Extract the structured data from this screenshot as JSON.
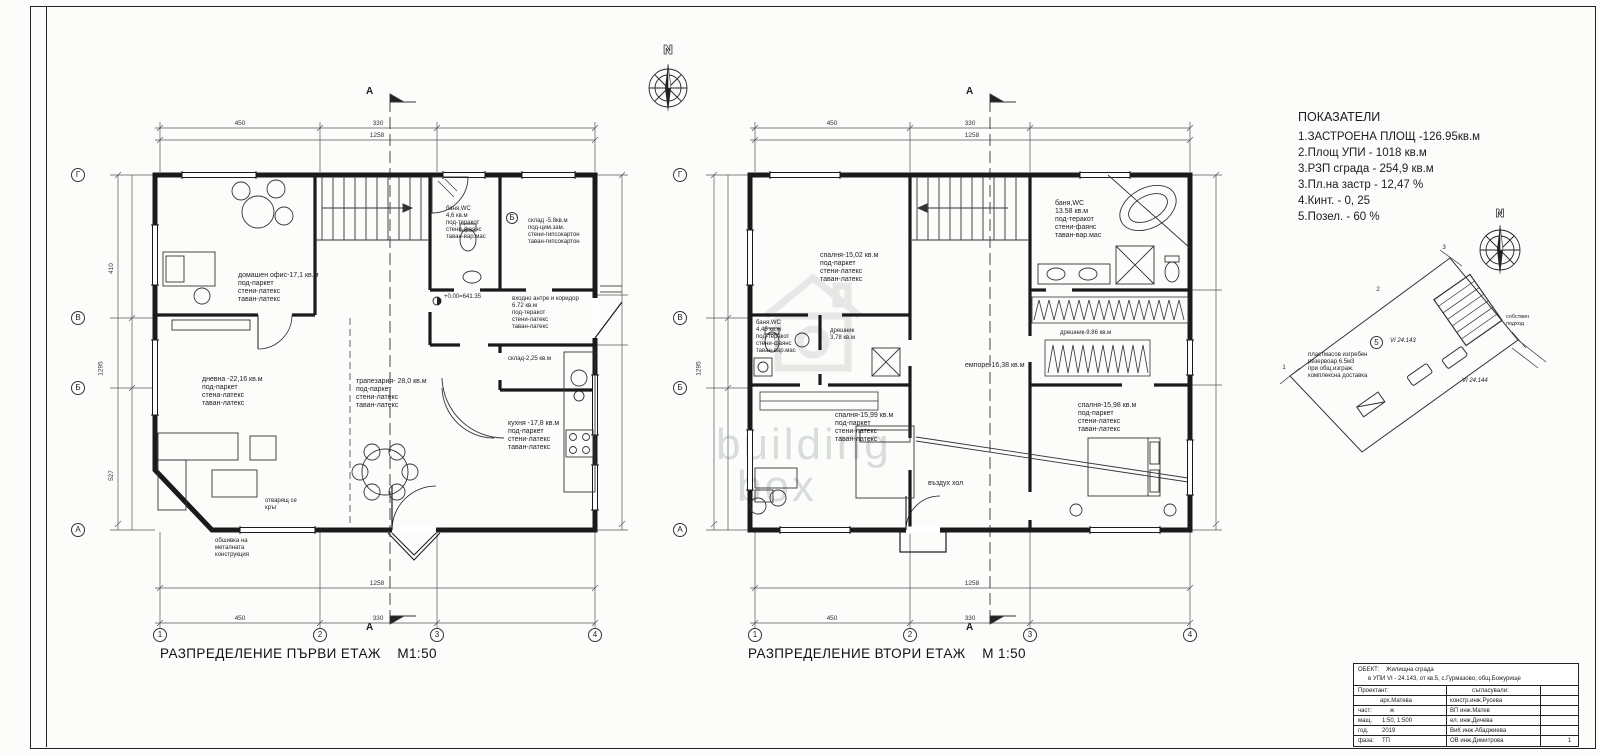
{
  "compass": {
    "label": "N"
  },
  "watermark": {
    "line1": "building",
    "line2": "box"
  },
  "indicators": {
    "title": "ПОКАЗАТЕЛИ",
    "items": [
      "1.ЗАСТРОЕНА ПЛОЩ -126.95кв.м",
      "2.Площ УПИ -  1018   кв.м",
      "3.РЗП  сграда - 254,9 кв.м",
      "3.Пл.на застр -   12,47 %",
      "4.Кинт.      - 0, 25",
      "5.Позел.    - 60 %"
    ]
  },
  "plans": [
    {
      "caption": "РАЗПРЕДЕЛЕНИЕ ПЪРВИ ЕТАЖ",
      "scale": "М1:50",
      "section_mark": "А",
      "detail_mark": "Б",
      "elevation": "+0.00=641.35",
      "grid_bottom": [
        "1",
        "2",
        "3",
        "4"
      ],
      "grid_left": [
        "Г",
        "В",
        "Б",
        "А"
      ],
      "dims": {
        "t1": "450",
        "t2": "330",
        "t_total": "1258",
        "b1": "450",
        "b2": "330",
        "b_total": "1258",
        "l1": "410",
        "l2": "1295",
        "l3": "527"
      },
      "rooms": {
        "office": {
          "name": "домашен офис-17,1 кв.м",
          "f": "под-паркет",
          "w": "стени-латекс",
          "c": "таван-латекс"
        },
        "bath": {
          "name": "баня,WC",
          "area": "4,6 кв.м",
          "f": "под-теракот",
          "w": "стени-фаянс",
          "c": "таван-вар.мас"
        },
        "storage": {
          "name": "склад -5.8кв.м",
          "f": "под-цим.зам.",
          "w": "стени-гипсокартон",
          "c": "таван-гипсокартон"
        },
        "hall": {
          "name": "входно антре и коридор",
          "area": "6.72 кв.м",
          "f": "под-теракот",
          "w": "стени-латекс",
          "c": "таван-латекс"
        },
        "storage2": {
          "name": "склад-2,25 кв.м"
        },
        "living": {
          "name": "дневна -22,16 кв.м",
          "f": "под-паркет",
          "w": "стена-латекс",
          "c": "таван-латекс"
        },
        "dining": {
          "name": "трапезария- 28,0 кв.м",
          "f": "под-паркет",
          "w": "стени-латекс",
          "c": "таван-латекс"
        },
        "kitchen": {
          "name": "кухня -17,8 кв.м",
          "f": "под-паркет",
          "w": "стени-латекс",
          "c": "таван-латекс"
        }
      },
      "notes": {
        "n1a": "отварящ се",
        "n1b": "кръг",
        "n2a": "обшивка на",
        "n2b": "металната",
        "n2c": "конструкция"
      }
    },
    {
      "caption": "РАЗПРЕДЕЛЕНИЕ ВТОРИ ЕТАЖ",
      "scale": "М 1:50",
      "section_mark": "А",
      "grid_bottom": [
        "1",
        "2",
        "3",
        "4"
      ],
      "grid_left": [
        "Г",
        "В",
        "Б",
        "А"
      ],
      "dims": {
        "t1": "450",
        "t2": "330",
        "t_total": "1258",
        "b1": "450",
        "b2": "330",
        "b_total": "1258",
        "l2": "1295"
      },
      "rooms": {
        "bedroom1": {
          "name": "спалня-15,02 кв.м",
          "f": "под-паркет",
          "w": "стени-латекс",
          "c": "таван-латекс"
        },
        "bath": {
          "name": "баня,WC",
          "area": "13.58 кв.м",
          "f": "под-теракот",
          "w": "стени-фаянс",
          "c": "таван-вар.мас"
        },
        "bath2": {
          "name": "баня,WC",
          "area": "4,45 кв.м",
          "f": "под-теракот",
          "w": "стени-фаянс",
          "c": "таван-вар.мас"
        },
        "closet1": {
          "name": "дрешник",
          "area": "3,78 кв.м"
        },
        "closet2": {
          "name": "дрешник-9.86 кв.м"
        },
        "gallery": {
          "name": "емпоре-16,38 кв.м"
        },
        "bedroom2": {
          "name": "спалня-15,99 кв.м",
          "f": "под-паркет",
          "w": "стени-латекс",
          "c": "таван-латекс"
        },
        "bedroom3": {
          "name": "спалня-15,98 кв.м",
          "f": "под-паркет",
          "w": "стени-латекс",
          "c": "таван-латекс"
        },
        "void": {
          "name": "въздух хол"
        }
      }
    }
  ],
  "site": {
    "c1": "1",
    "c2": "2",
    "c3": "3",
    "badge": "5",
    "parcel": "VI 24.143",
    "parcel2": "VI 24.144",
    "n1": "пластмасов изгребен",
    "n2": "резервоар 6.5м3",
    "n3": "при общ.изграж.",
    "n4": "комплексна доставка",
    "access1": "собствен",
    "access2": "подход"
  },
  "title_block": {
    "object_label": "ОБЕКТ:",
    "object_line1": "Жилищна сграда",
    "object_line2": "в УПИ VI - 24.143, от кв.5, с.Гурмазово, общ.Божурище",
    "designer_label": "Проектант:",
    "designer": "арх.Матева",
    "agreed_label": "съгласували:",
    "r1l": "част:",
    "r1v": "ж",
    "r2l": "мащ.",
    "r2v": "1:50, 1:500",
    "r3l": "год.",
    "r3v": "2019",
    "r4l": "фаза:",
    "r4v": "ТП",
    "e1": "констр.инж.Русева",
    "e2": "ВП  инж.Матев",
    "e3": "ел.  инж.Дичева",
    "e4": "ВиК инж.Абаджиева",
    "e5": "ОВ  инж.Димитрова",
    "sheet_no": "1"
  }
}
